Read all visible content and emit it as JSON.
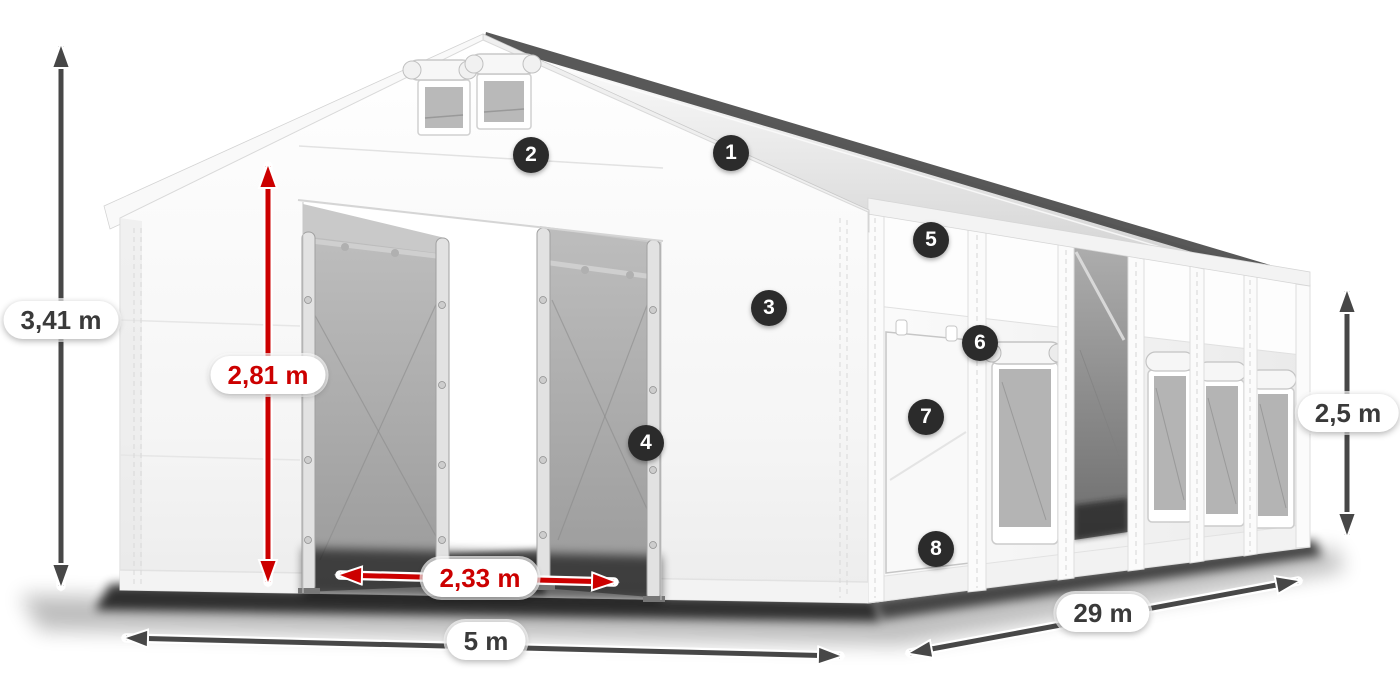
{
  "figure": {
    "title": "Industrial storage tent with dimension callouts",
    "callouts": [
      {
        "number": "1"
      },
      {
        "number": "2"
      },
      {
        "number": "3"
      },
      {
        "number": "4"
      },
      {
        "number": "5"
      },
      {
        "number": "6"
      },
      {
        "number": "7"
      },
      {
        "number": "8"
      }
    ],
    "dimensions": [
      {
        "id": "total-height",
        "label": "3,41 m",
        "color": "dark"
      },
      {
        "id": "entrance-height",
        "label": "2,81 m",
        "color": "red"
      },
      {
        "id": "entrance-width",
        "label": "2,33 m",
        "color": "red"
      },
      {
        "id": "gable-width",
        "label": "5 m",
        "color": "dark"
      },
      {
        "id": "side-length",
        "label": "29 m",
        "color": "dark"
      },
      {
        "id": "side-wall-height",
        "label": "2,5 m",
        "color": "dark"
      }
    ],
    "colors": {
      "dimension_red": "#cc0000",
      "dimension_dark": "#474747",
      "badge_background": "#2b2b2b",
      "badge_text": "#ffffff",
      "tent_white": "#f8f8f8",
      "mesh_gray": "#a9a9a9"
    }
  }
}
